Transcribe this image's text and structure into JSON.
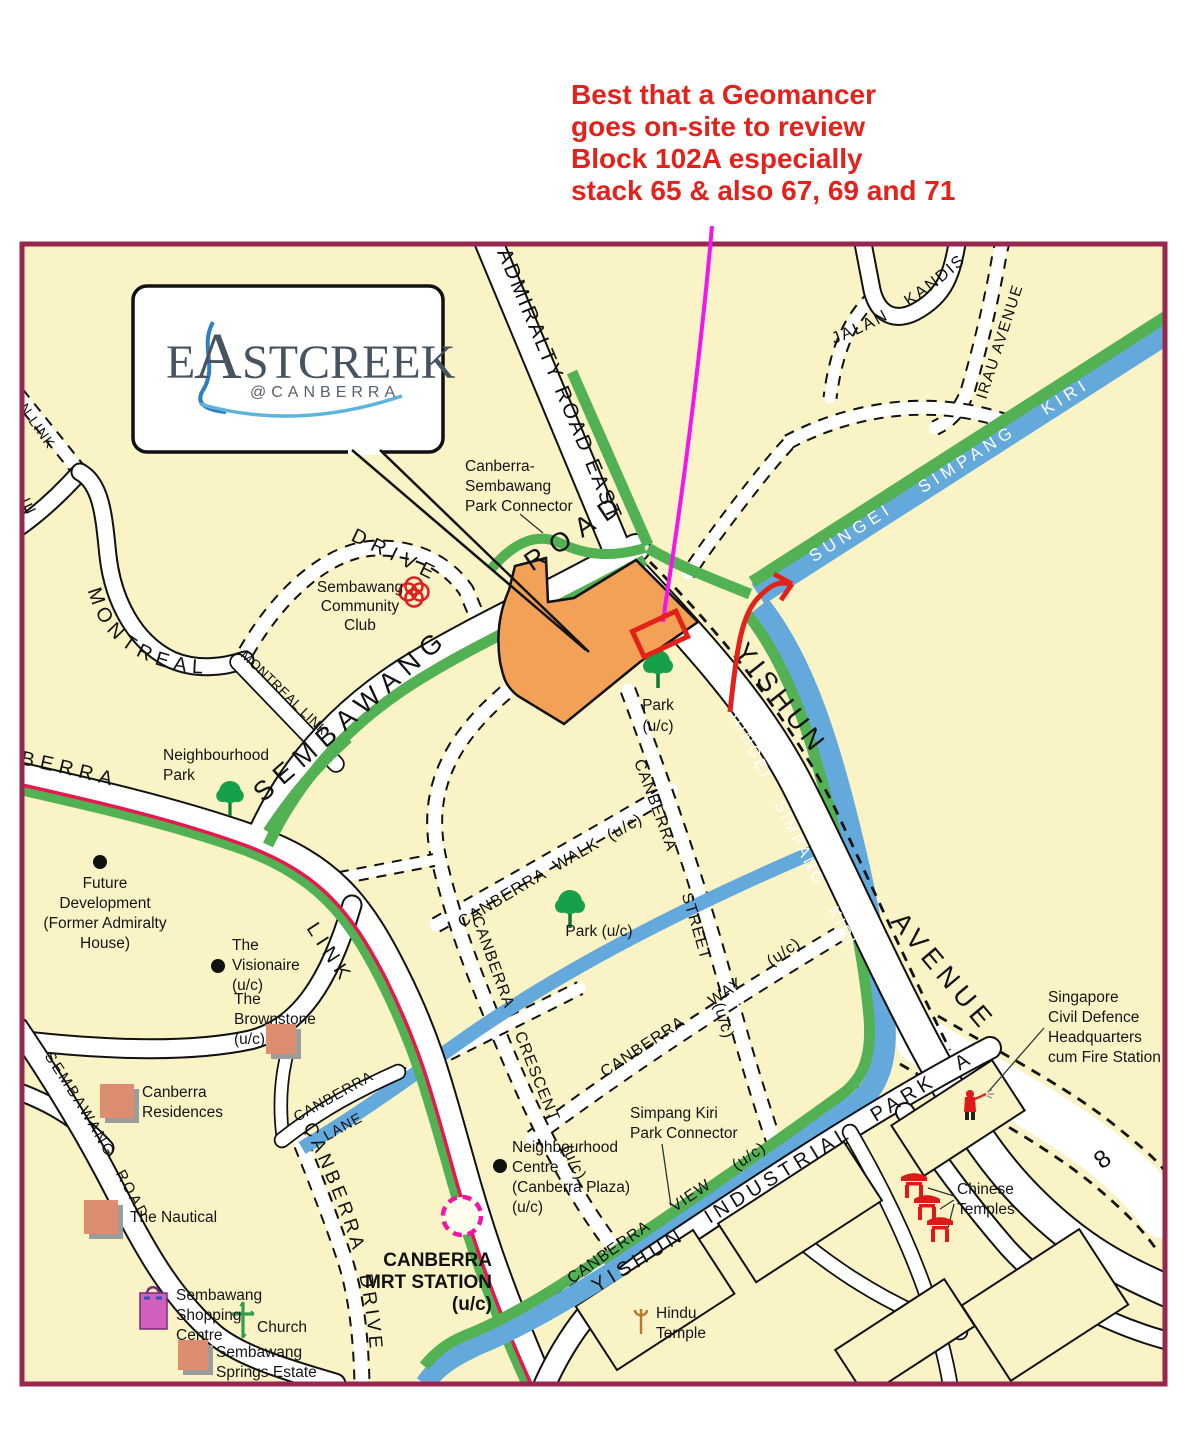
{
  "annotation": {
    "line1": "Best that a Geomancer",
    "line2": "goes on-site to review",
    "line3": "Block 102A especially",
    "line4": "stack 65 & also 67, 69 and 71"
  },
  "logo": {
    "e": "E",
    "a": "A",
    "rest": "STCREEK",
    "sub": "@CANBERRA"
  },
  "road_labels": {
    "admiralty": "ADMIRALTY ROAD EAST",
    "sembawang_road": "ROAD",
    "sembawang": "SEMBAWANG",
    "montreal": "MONTREAL",
    "drive": "DRIVE",
    "montreal_link": "MONTREAL LINK",
    "on_link": "ON LINK",
    "le": "LE",
    "canberra_west": "NBERRA",
    "link": "LINK",
    "jalan_kandis": "JALAN KANDIS",
    "irau_avenue": "IRAU AVENUE",
    "sungei_upper": "SUNGEI SIMPANG KIRI",
    "sungei_lower": "SUNGEI SIMPANG KIRI",
    "yishun": "YISHUN",
    "avenue": "AVENUE",
    "canberra_walk": "CANBERRA WALK (u/c)",
    "canberra_street": "CANBERRA STREET (u/c)",
    "canberra_way": "CANBERRA WAY (u/c)",
    "canberra_crescent": "CANBERRA CRESCENT (u/c)",
    "canberra_view": "CANBERRA VIEW (u/c)",
    "canberra_lane_1": "CANBERRA",
    "canberra_lane_2": "LANE",
    "canberra_drive": "CANBERRA DRIVE",
    "sembawang_road_bl": "SEMBAWANG ROAD",
    "yishun_industrial": "YISHUN INDUSTRIAL PARK A",
    "eight": "8",
    "g_fragment": "g"
  },
  "poi": {
    "pc_connector": [
      "Canberra-",
      "Sembawang",
      "Park Connector"
    ],
    "community_club": [
      "Sembawang",
      "Community",
      "Club"
    ],
    "neighbourhood_park": [
      "Neighbourhood",
      "Park"
    ],
    "future_dev": [
      "Future",
      "Development",
      "(Former Admiralty",
      "House)"
    ],
    "visionaire": [
      "The",
      "Visionaire",
      "(u/c)"
    ],
    "brownstone": [
      "The",
      "Brownstone",
      "(u/c)"
    ],
    "residences": [
      "Canberra",
      "Residences"
    ],
    "nautical": [
      "The Nautical"
    ],
    "shopping": [
      "Sembawang",
      "Shopping",
      "Centre"
    ],
    "church": [
      "Church"
    ],
    "springs": [
      "Sembawang",
      "Springs Estate"
    ],
    "mrt": [
      "CANBERRA",
      "MRT STATION",
      "(u/c)"
    ],
    "ncentre": [
      "Neighbourhood",
      "Centre",
      "(Canberra Plaza)",
      "(u/c)"
    ],
    "simpang_pc": [
      "Simpang Kiri",
      "Park Connector"
    ],
    "hindu": [
      "Hindu",
      "Temple"
    ],
    "chinese": [
      "Chinese",
      "Temples"
    ],
    "scdf": [
      "Singapore",
      "Civil Defence",
      "Headquarters",
      "cum Fire Station"
    ],
    "park_site": [
      "Park",
      "(u/c)"
    ],
    "park_central": [
      "Park (u/c)"
    ]
  },
  "colors": {
    "map_bg": "#FAF3C6",
    "map_border": "#99264F",
    "water": "#64A9DC",
    "green": "#52B153",
    "site": "#F2A157",
    "red": "#E32119",
    "annotation_red": "#E3221B",
    "magenta": "#F414EC",
    "mrt_line": "#E8174F",
    "mrt_pink": "#F316A2",
    "salmon": "#DD8E71",
    "logo_slate": "#47545F",
    "logo_blue": "#2F7FBE"
  }
}
